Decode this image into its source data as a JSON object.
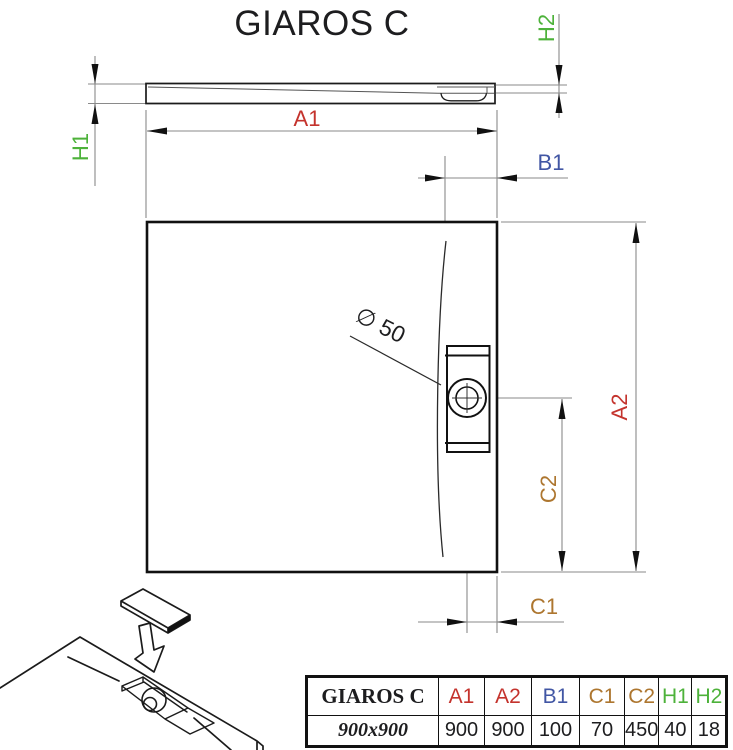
{
  "title": "GIAROS C",
  "colors": {
    "red": "#c4332d",
    "blue": "#4156a4",
    "brown": "#ad762f",
    "green": "#4db23a",
    "ink": "#1d1d1f"
  },
  "drawing": {
    "labels": {
      "a1": "A1",
      "a2": "A2",
      "b1": "B1",
      "c1": "C1",
      "c2": "C2",
      "h1": "H1",
      "h2": "H2",
      "drain_diameter": "∅ 50"
    }
  },
  "table": {
    "headers": [
      {
        "label": "GIAROS C",
        "color": "#1d1d1f"
      },
      {
        "label": "A1",
        "color": "#c4332d"
      },
      {
        "label": "A2",
        "color": "#c4332d"
      },
      {
        "label": "B1",
        "color": "#4156a4"
      },
      {
        "label": "C1",
        "color": "#ad762f"
      },
      {
        "label": "C2",
        "color": "#ad762f"
      },
      {
        "label": "H1",
        "color": "#4db23a"
      },
      {
        "label": "H2",
        "color": "#4db23a"
      }
    ],
    "row": [
      "900x900",
      "900",
      "900",
      "100",
      "70",
      "450",
      "40",
      "18"
    ]
  }
}
